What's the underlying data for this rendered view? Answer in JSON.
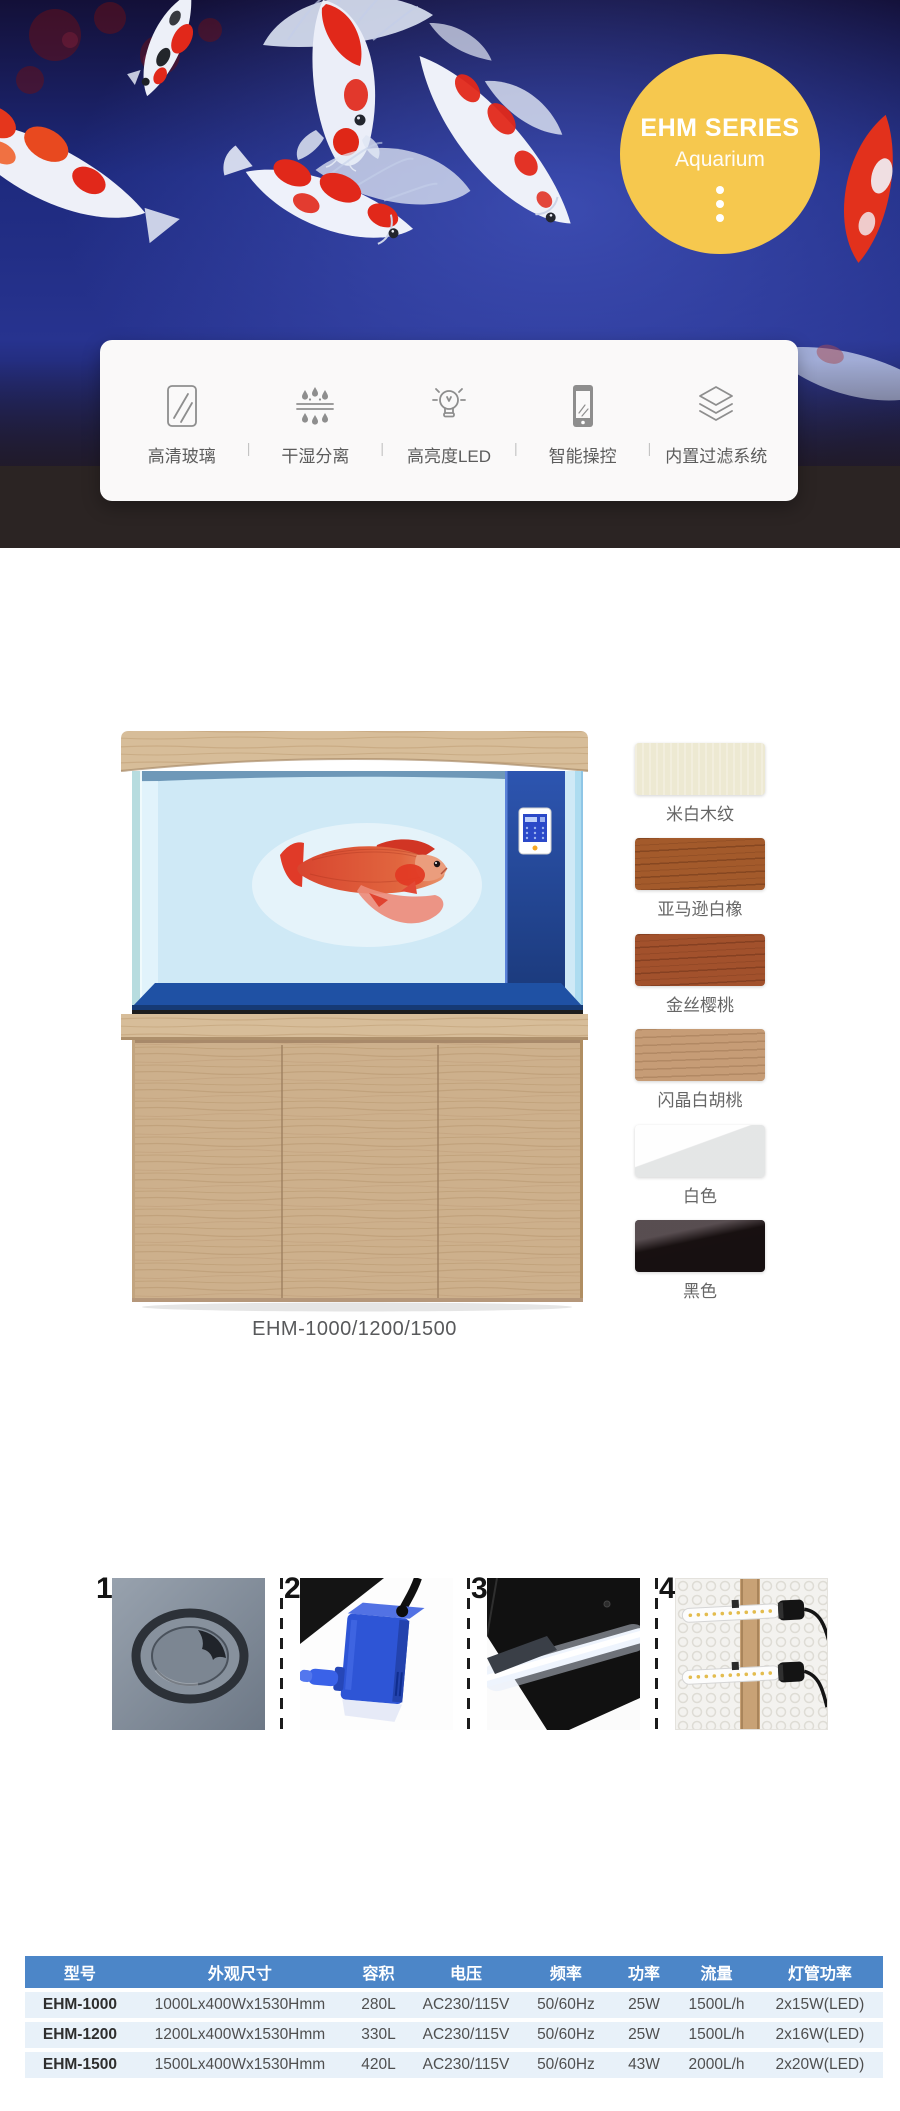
{
  "hero": {
    "badge": {
      "title": "EHM SERIES",
      "subtitle": "Aquarium"
    }
  },
  "features": {
    "divider": "|",
    "items": [
      {
        "icon": "glass-pane-icon",
        "label": "高清玻璃"
      },
      {
        "icon": "dry-wet-separation-icon",
        "label": "干湿分离"
      },
      {
        "icon": "led-bulb-icon",
        "label": "高亮度LED"
      },
      {
        "icon": "smart-control-icon",
        "label": "智能操控"
      },
      {
        "icon": "filter-layers-icon",
        "label": "内置过滤系统"
      }
    ]
  },
  "product": {
    "caption": "EHM-1000/1200/1500",
    "swatches": [
      {
        "label": "米白木纹",
        "color": "#EDE9D2"
      },
      {
        "label": "亚马逊白橡",
        "color": "#A35A2B"
      },
      {
        "label": "金丝樱桃",
        "color": "#A2512C"
      },
      {
        "label": "闪晶白胡桃",
        "color": "#C69C76"
      },
      {
        "label": "白色",
        "color": "#F5F5F4"
      },
      {
        "label": "黑色",
        "color": "#171011"
      }
    ]
  },
  "details": {
    "items": [
      {
        "number": "1",
        "name": "feeding-hole-photo"
      },
      {
        "number": "2",
        "name": "filter-box-photo"
      },
      {
        "number": "3",
        "name": "led-lid-photo"
      },
      {
        "number": "4",
        "name": "led-tubes-photo"
      }
    ]
  },
  "spec_table": {
    "headers": [
      "型号",
      "外观尺寸",
      "容积",
      "电压",
      "频率",
      "功率",
      "流量",
      "灯管功率"
    ],
    "rows": [
      [
        "EHM-1000",
        "1000Lx400Wx1530Hmm",
        "280L",
        "AC230/115V",
        "50/60Hz",
        "25W",
        "1500L/h",
        "2x15W(LED)"
      ],
      [
        "EHM-1200",
        "1200Lx400Wx1530Hmm",
        "330L",
        "AC230/115V",
        "50/60Hz",
        "25W",
        "1500L/h",
        "2x16W(LED)"
      ],
      [
        "EHM-1500",
        "1500Lx400Wx1530Hmm",
        "420L",
        "AC230/115V",
        "50/60Hz",
        "43W",
        "2000L/h",
        "2x20W(LED)"
      ]
    ]
  },
  "colors": {
    "accent_yellow": "#F6C84E",
    "table_header_bg": "#4C86C8",
    "table_row_bg": "#E8F1F9",
    "hero_footer_bg": "#2B2424"
  }
}
